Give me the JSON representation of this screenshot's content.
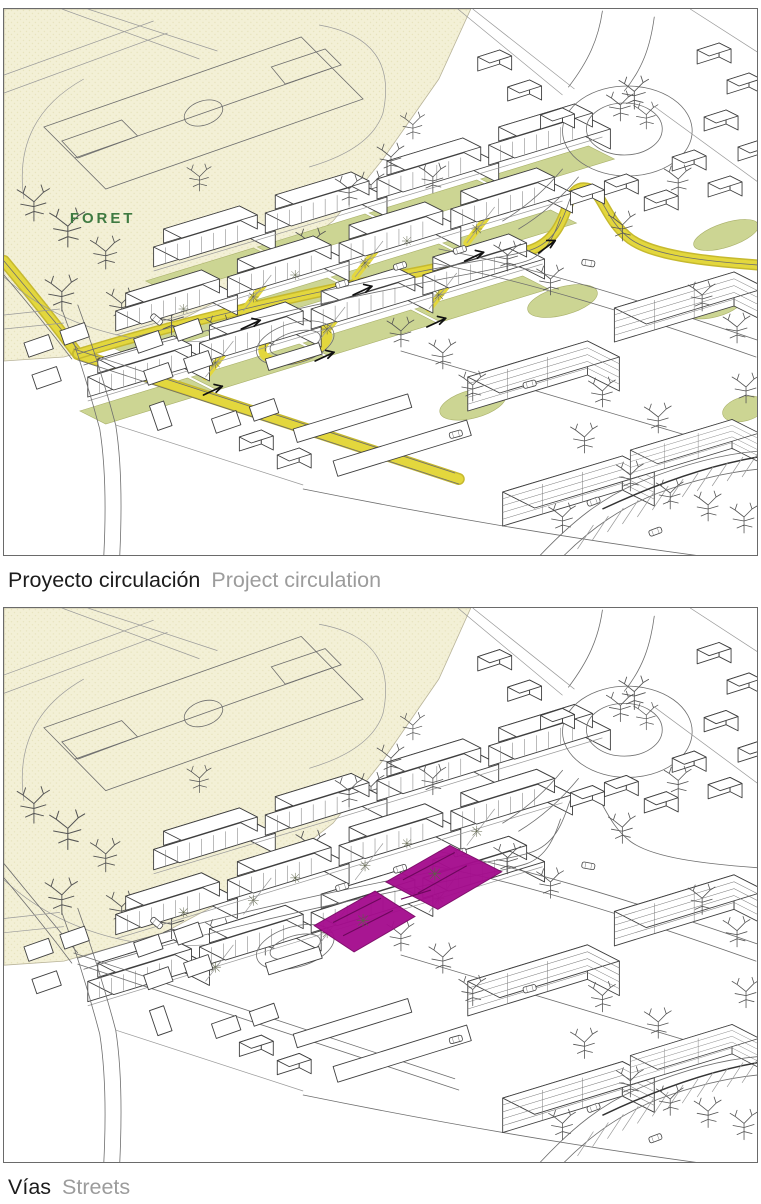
{
  "panels": [
    {
      "id": "project-circulation",
      "caption_primary": "Proyecto circulación",
      "caption_secondary": "Project circulation",
      "map_label": "FORET"
    },
    {
      "id": "streets",
      "caption_primary": "Vías",
      "caption_secondary": "Streets"
    }
  ],
  "colors": {
    "circulation_yellow": "#e3d73d",
    "circulation_yellow_edge": "#c6b92f",
    "courtyard_green": "#ccd593",
    "forest_beige": "#f3f0d6",
    "forest_dot": "#e7e3bd",
    "street_magenta": "#a50d8e",
    "street_magenta_dark": "#6d075c",
    "map_label_green": "#3e7a41",
    "caption_primary_color": "#1c1c1c",
    "caption_secondary_color": "#9c9c9c",
    "line_gray": "#6e6e6e",
    "building_stroke": "#3f3f3f",
    "panel_border": "#6a6a6a"
  }
}
